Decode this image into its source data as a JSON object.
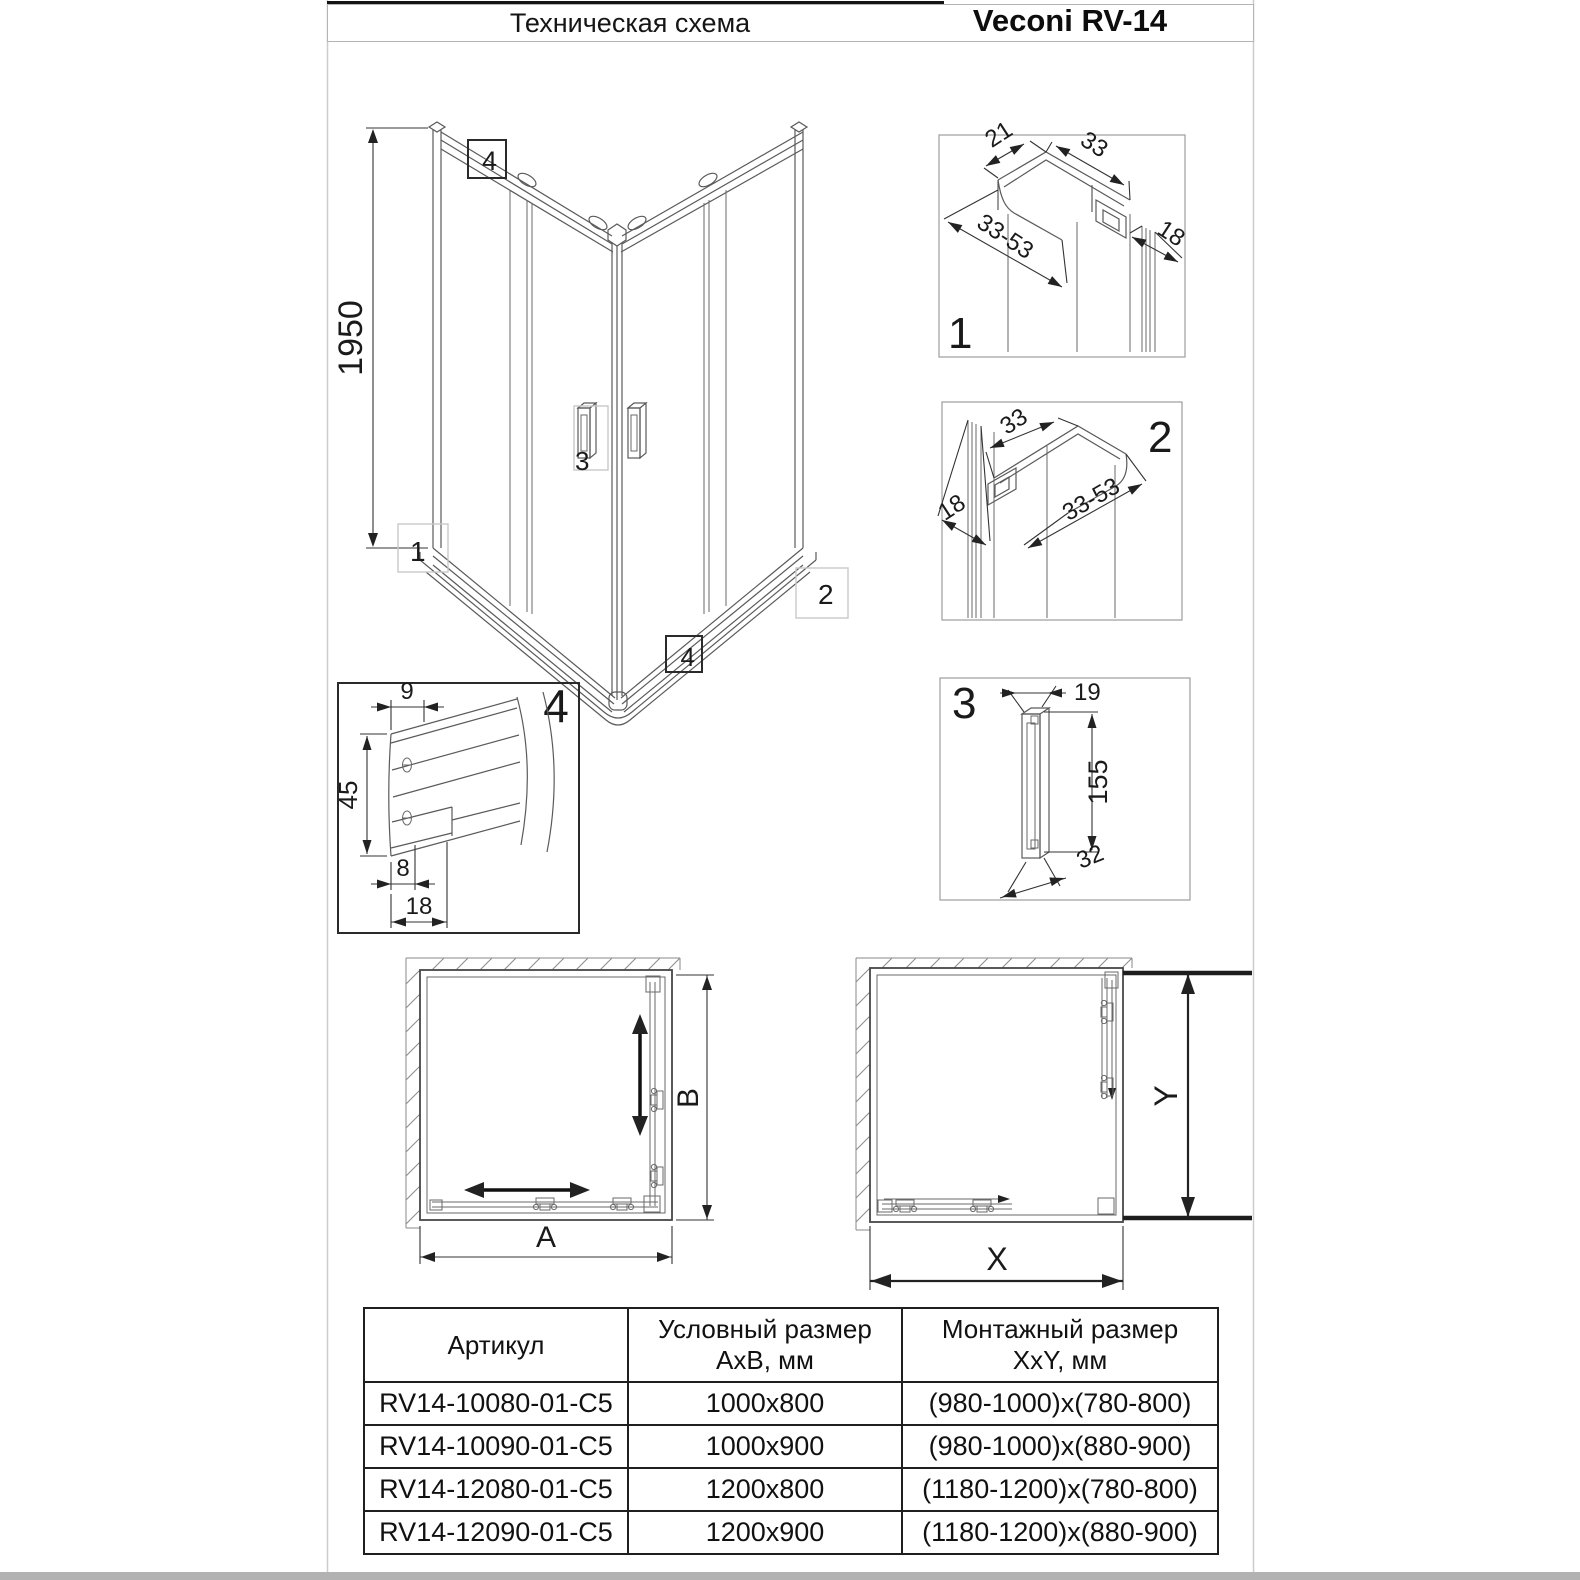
{
  "header": {
    "title": "Техническая схема",
    "brand": "Veconi RV-14"
  },
  "main_view": {
    "height_dim": "1950",
    "callout_top": "4",
    "callout_bottom": "4",
    "callout_left": "1",
    "callout_right": "2",
    "callout_handle": "3"
  },
  "details": {
    "d1": {
      "label": "1",
      "dim_offset": "21",
      "dim_profile": "33",
      "dim_adjust": "33-53",
      "dim_glass": "18"
    },
    "d2": {
      "label": "2",
      "dim_profile": "33",
      "dim_glass": "18",
      "dim_adjust": "33-53"
    },
    "d3": {
      "label": "3",
      "dim_depth": "19",
      "dim_height": "155",
      "dim_width": "32"
    },
    "d4": {
      "label": "4",
      "dim_top": "9",
      "dim_height": "45",
      "dim_inner": "8",
      "dim_base": "18"
    }
  },
  "plans": {
    "left": {
      "dim_width": "A",
      "dim_depth": "B"
    },
    "right": {
      "dim_width": "X",
      "dim_depth": "Y"
    }
  },
  "table": {
    "col1_header": "Артикул",
    "col2_header_line1": "Условный размер",
    "col2_header_line2": "AxB, мм",
    "col3_header_line1": "Монтажный размер",
    "col3_header_line2": "XxY, мм",
    "rows": [
      {
        "article": "RV14-10080-01-C5",
        "size": "1000x800",
        "mount": "(980-1000)x(780-800)"
      },
      {
        "article": "RV14-10090-01-C5",
        "size": "1000x900",
        "mount": "(980-1000)x(880-900)"
      },
      {
        "article": "RV14-12080-01-C5",
        "size": "1200x800",
        "mount": "(1180-1200)x(780-800)"
      },
      {
        "article": "RV14-12090-01-C5",
        "size": "1200x900",
        "mount": "(1180-1200)x(880-900)"
      }
    ]
  }
}
